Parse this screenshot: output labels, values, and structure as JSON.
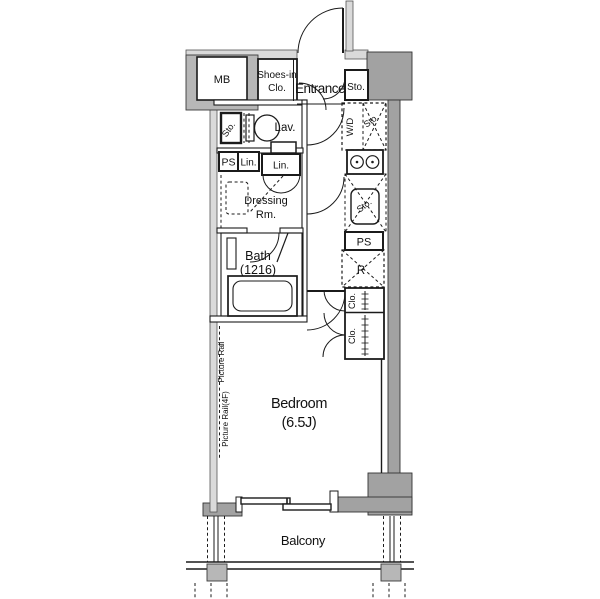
{
  "rooms": {
    "mb": "MB",
    "shoes_in_closet_line1": "Shoes-in",
    "shoes_in_closet_line2": "Clo.",
    "entrance": "Entrance",
    "entrance_storage": "Sto.",
    "washer_dryer": "W/D",
    "washer_storage": "Sto.",
    "lavatory": "Lav.",
    "lavatory_storage": "Sto.",
    "pipe_space_left": "PS",
    "linen_1": "Lin.",
    "linen_2": "Lin.",
    "dressing_line1": "Dressing",
    "dressing_line2": "Rm.",
    "bath_line1": "Bath",
    "bath_line2": "(1216)",
    "kitchen_storage": "Sto.",
    "pipe_space_right": "PS",
    "refrigerator": "R",
    "closet_1": "Clo.",
    "closet_2": "Clo.",
    "bedroom_line1": "Bedroom",
    "bedroom_line2": "(6.5J)",
    "balcony": "Balcony"
  },
  "annotations": {
    "picture_rail_upper": "Picture Rail",
    "picture_rail_lower": "Picture Rail(4F)"
  },
  "colors": {
    "structural_wall": "#a2a2a2",
    "meter_box_wall": "#b7b7b7",
    "light_wall_band": "#dadada",
    "line": "#1b1b1b",
    "background": "#ffffff"
  }
}
